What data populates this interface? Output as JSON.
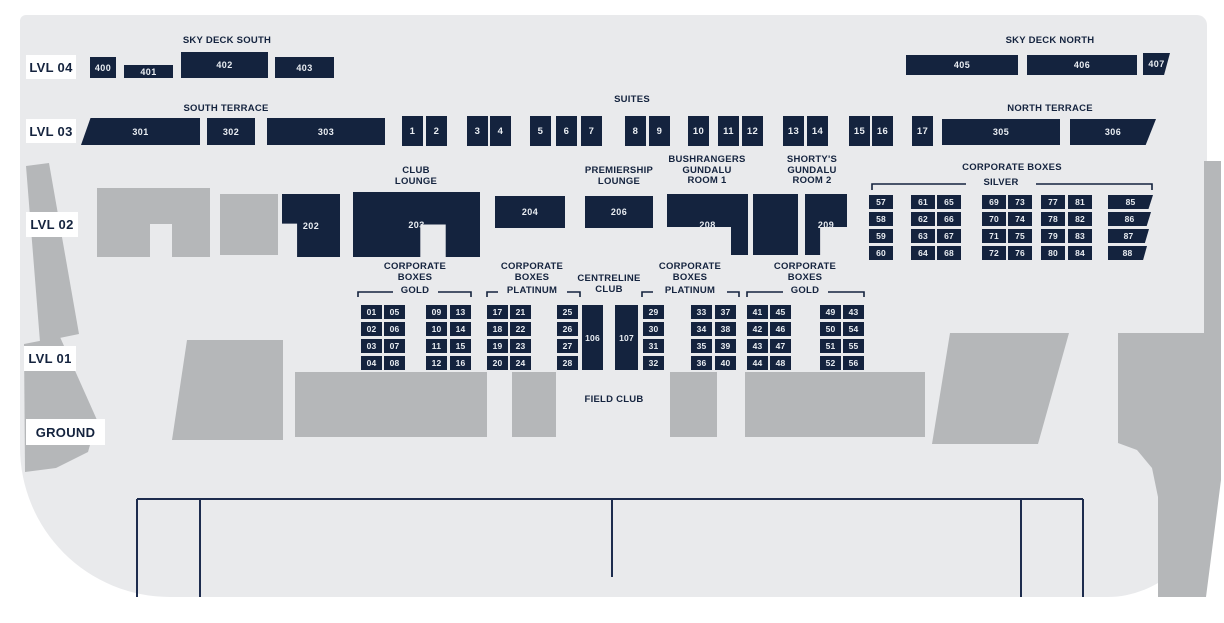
{
  "palette": {
    "navy": "#14233e",
    "bg": "#e9eaec",
    "gray": "#b5b7b9",
    "white": "#ffffff",
    "line": "#1d2c4e"
  },
  "map_bg": {
    "x": 20,
    "y": 15,
    "w": 1187,
    "h": 582
  },
  "level_labels": [
    {
      "id": "lvl-04",
      "text": "LVL 04",
      "x": 26,
      "y": 55,
      "w": 50,
      "h": 24
    },
    {
      "id": "lvl-03",
      "text": "LVL 03",
      "x": 26,
      "y": 119,
      "w": 50,
      "h": 24
    },
    {
      "id": "lvl-02",
      "text": "LVL 02",
      "x": 26,
      "y": 212,
      "w": 52,
      "h": 25
    },
    {
      "id": "lvl-01",
      "text": "LVL 01",
      "x": 24,
      "y": 346,
      "w": 52,
      "h": 25
    },
    {
      "id": "ground",
      "text": "GROUND",
      "x": 26,
      "y": 419,
      "w": 79,
      "h": 26
    }
  ],
  "headers": [
    {
      "name": "sky-deck-south-header",
      "lines": [
        "SKY DECK SOUTH"
      ],
      "cx": 227,
      "y": 36
    },
    {
      "name": "sky-deck-north-header",
      "lines": [
        "SKY DECK NORTH"
      ],
      "cx": 1050,
      "y": 36
    },
    {
      "name": "south-terrace-header",
      "lines": [
        "SOUTH TERRACE"
      ],
      "cx": 226,
      "y": 104
    },
    {
      "name": "suites-header",
      "lines": [
        "SUITES"
      ],
      "cx": 632,
      "y": 95
    },
    {
      "name": "north-terrace-header",
      "lines": [
        "NORTH TERRACE"
      ],
      "cx": 1050,
      "y": 104
    },
    {
      "name": "club-lounge-header",
      "lines": [
        "CLUB",
        "LOUNGE"
      ],
      "cx": 416,
      "y": 166
    },
    {
      "name": "premiership-lounge-header",
      "lines": [
        "PREMIERSHIP",
        "LOUNGE"
      ],
      "cx": 619,
      "y": 166
    },
    {
      "name": "bushrangers-gundalu-room-1-header",
      "lines": [
        "BUSHRANGERS",
        "GUNDALU",
        "ROOM 1"
      ],
      "cx": 707,
      "y": 155
    },
    {
      "name": "shortys-gundalu-room-2-header",
      "lines": [
        "SHORTY'S",
        "GUNDALU",
        "ROOM 2"
      ],
      "cx": 812,
      "y": 155
    },
    {
      "name": "corporate-boxes-silver-header",
      "lines": [
        "CORPORATE BOXES"
      ],
      "cx": 1012,
      "y": 163
    },
    {
      "name": "silver-label",
      "lines": [
        "SILVER"
      ],
      "cx": 1001,
      "y": 178
    },
    {
      "name": "corporate-boxes-gold-left-header",
      "lines": [
        "CORPORATE",
        "BOXES"
      ],
      "cx": 415,
      "y": 262
    },
    {
      "name": "gold-left-label",
      "lines": [
        "GOLD"
      ],
      "cx": 415,
      "y": 286
    },
    {
      "name": "corporate-boxes-platinum-left-header",
      "lines": [
        "CORPORATE",
        "BOXES"
      ],
      "cx": 532,
      "y": 262
    },
    {
      "name": "platinum-left-label",
      "lines": [
        "PLATINUM"
      ],
      "cx": 532,
      "y": 286
    },
    {
      "name": "centreline-club-header",
      "lines": [
        "CENTRELINE",
        "CLUB"
      ],
      "cx": 609,
      "y": 274
    },
    {
      "name": "corporate-boxes-platinum-right-header",
      "lines": [
        "CORPORATE",
        "BOXES"
      ],
      "cx": 690,
      "y": 262
    },
    {
      "name": "platinum-right-label",
      "lines": [
        "PLATINUM"
      ],
      "cx": 690,
      "y": 286
    },
    {
      "name": "corporate-boxes-gold-right-header",
      "lines": [
        "CORPORATE",
        "BOXES"
      ],
      "cx": 805,
      "y": 262
    },
    {
      "name": "gold-right-label",
      "lines": [
        "GOLD"
      ],
      "cx": 805,
      "y": 286
    },
    {
      "name": "field-club-label",
      "lines": [
        "FIELD CLUB"
      ],
      "cx": 614,
      "y": 395
    }
  ],
  "brackets": [
    {
      "name": "silver-bracket",
      "x1": 872,
      "x2": 1152,
      "y": 184,
      "g1": 966,
      "g2": 1036,
      "tick": 6
    },
    {
      "name": "gold-left-bracket",
      "x1": 358,
      "x2": 471,
      "y": 292,
      "g1": 393,
      "g2": 438,
      "tick": 5
    },
    {
      "name": "platinum-left-bracket",
      "x1": 487,
      "x2": 580,
      "y": 292,
      "g1": 498,
      "g2": 567,
      "tick": 5
    },
    {
      "name": "platinum-right-bracket",
      "x1": 642,
      "x2": 739,
      "y": 292,
      "g1": 653,
      "g2": 727,
      "tick": 5
    },
    {
      "name": "gold-right-bracket",
      "x1": 747,
      "x2": 864,
      "y": 292,
      "g1": 783,
      "g2": 828,
      "tick": 5
    }
  ],
  "sections": [
    {
      "label": "400",
      "kind": "section",
      "x": 90,
      "y": 57,
      "w": 26,
      "h": 21
    },
    {
      "label": "401",
      "kind": "section",
      "x": 124,
      "y": 65,
      "w": 49,
      "h": 13
    },
    {
      "label": "402",
      "kind": "section",
      "x": 181,
      "y": 52,
      "w": 87,
      "h": 26
    },
    {
      "label": "403",
      "kind": "section",
      "x": 275,
      "y": 57,
      "w": 59,
      "h": 21
    },
    {
      "label": "405",
      "kind": "section",
      "x": 906,
      "y": 55,
      "w": 112,
      "h": 20
    },
    {
      "label": "406",
      "kind": "section",
      "x": 1027,
      "y": 55,
      "w": 110,
      "h": 20
    },
    {
      "label": "407",
      "kind": "section",
      "x": 1143,
      "y": 53,
      "w": 27,
      "h": 22,
      "clip": "polygon(0 0,100% 0,78% 100%,0 100%)"
    },
    {
      "label": "301",
      "kind": "section",
      "x": 81,
      "y": 118,
      "w": 119,
      "h": 27,
      "clip": "polygon(8% 0,100% 0,100% 100%,0 100%)"
    },
    {
      "label": "302",
      "kind": "section",
      "x": 207,
      "y": 118,
      "w": 48,
      "h": 27
    },
    {
      "label": "303",
      "kind": "section",
      "x": 267,
      "y": 118,
      "w": 118,
      "h": 27
    },
    {
      "label": "305",
      "kind": "section",
      "x": 942,
      "y": 119,
      "w": 118,
      "h": 26
    },
    {
      "label": "306",
      "kind": "section",
      "x": 1070,
      "y": 119,
      "w": 86,
      "h": 26,
      "clip": "polygon(0 0,100% 0,88% 100%,0 100%)"
    },
    {
      "label": "202",
      "kind": "section",
      "x": 282,
      "y": 194,
      "w": 58,
      "h": 63,
      "clip": "polygon(0 0,100% 0,100% 100%,26% 100%,26% 47%,0 47%)"
    },
    {
      "label": "203",
      "kind": "section",
      "x": 353,
      "y": 192,
      "w": 127,
      "h": 65,
      "clip": "polygon(0 0,100% 0,100% 100%,73% 100%,73% 50%,53% 50%,53% 100%,0 100%)"
    },
    {
      "label": "204",
      "kind": "section",
      "x": 495,
      "y": 196,
      "w": 70,
      "h": 32
    },
    {
      "label": "206",
      "kind": "section",
      "x": 585,
      "y": 196,
      "w": 68,
      "h": 32
    },
    {
      "label": "208",
      "kind": "section",
      "x": 667,
      "y": 194,
      "w": 81,
      "h": 61,
      "clip": "polygon(0 0,100% 0,100% 100%,79% 100%,79% 54%,0 54%)"
    },
    {
      "label": "",
      "kind": "section",
      "x": 753,
      "y": 194,
      "w": 45,
      "h": 61
    },
    {
      "label": "209",
      "kind": "section",
      "x": 805,
      "y": 194,
      "w": 42,
      "h": 61,
      "clip": "polygon(0 0,100% 0,100% 54%,36% 54%,36% 100%,0 100%)"
    },
    {
      "label": "106",
      "kind": "section",
      "x": 582,
      "y": 305,
      "w": 21,
      "h": 65,
      "corp": true
    },
    {
      "label": "107",
      "kind": "section",
      "x": 615,
      "y": 305,
      "w": 23,
      "h": 65,
      "corp": true
    }
  ],
  "suites": {
    "y": 116,
    "w": 21,
    "h": 30,
    "items": [
      {
        "label": "1",
        "x": 402
      },
      {
        "label": "2",
        "x": 426
      },
      {
        "label": "3",
        "x": 467
      },
      {
        "label": "4",
        "x": 490
      },
      {
        "label": "5",
        "x": 530
      },
      {
        "label": "6",
        "x": 556
      },
      {
        "label": "7",
        "x": 581
      },
      {
        "label": "8",
        "x": 625
      },
      {
        "label": "9",
        "x": 649
      },
      {
        "label": "10",
        "x": 688
      },
      {
        "label": "11",
        "x": 718
      },
      {
        "label": "12",
        "x": 742
      },
      {
        "label": "13",
        "x": 783
      },
      {
        "label": "14",
        "x": 807
      },
      {
        "label": "15",
        "x": 849
      },
      {
        "label": "16",
        "x": 872
      },
      {
        "label": "17",
        "x": 912
      }
    ]
  },
  "grids": [
    {
      "name": "corporate-boxes-silver",
      "w": 24,
      "h": 14,
      "row_ys": [
        195,
        212,
        229,
        246
      ],
      "cols": [
        {
          "x": 869,
          "labels": [
            "57",
            "58",
            "59",
            "60"
          ]
        },
        {
          "x": 911,
          "labels": [
            "61",
            "62",
            "63",
            "64"
          ]
        },
        {
          "x": 937,
          "labels": [
            "65",
            "66",
            "67",
            "68"
          ]
        },
        {
          "x": 982,
          "labels": [
            "69",
            "70",
            "71",
            "72"
          ]
        },
        {
          "x": 1008,
          "labels": [
            "73",
            "74",
            "75",
            "76"
          ]
        },
        {
          "x": 1041,
          "labels": [
            "77",
            "78",
            "79",
            "80"
          ]
        },
        {
          "x": 1068,
          "labels": [
            "81",
            "82",
            "83",
            "84"
          ]
        },
        {
          "x": 1108,
          "labels": [
            "85",
            "86",
            "87",
            "88"
          ],
          "widths": [
            45,
            43,
            41,
            39
          ],
          "clip": "polygon(0 0,100% 0,90% 100%,0 100%)"
        }
      ]
    },
    {
      "name": "corporate-boxes-lvl01",
      "w": 21,
      "h": 14,
      "row_ys": [
        305,
        322,
        339,
        356
      ],
      "cols": [
        {
          "x": 361,
          "labels": [
            "01",
            "02",
            "03",
            "04"
          ]
        },
        {
          "x": 384,
          "labels": [
            "05",
            "06",
            "07",
            "08"
          ]
        },
        {
          "x": 426,
          "labels": [
            "09",
            "10",
            "11",
            "12"
          ]
        },
        {
          "x": 450,
          "labels": [
            "13",
            "14",
            "15",
            "16"
          ]
        },
        {
          "x": 487,
          "labels": [
            "17",
            "18",
            "19",
            "20"
          ]
        },
        {
          "x": 510,
          "labels": [
            "21",
            "22",
            "23",
            "24"
          ]
        },
        {
          "x": 557,
          "labels": [
            "25",
            "26",
            "27",
            "28"
          ]
        },
        {
          "x": 643,
          "labels": [
            "29",
            "30",
            "31",
            "32"
          ]
        },
        {
          "x": 691,
          "labels": [
            "33",
            "34",
            "35",
            "36"
          ]
        },
        {
          "x": 715,
          "labels": [
            "37",
            "38",
            "39",
            "40"
          ]
        },
        {
          "x": 747,
          "labels": [
            "41",
            "42",
            "43",
            "44"
          ]
        },
        {
          "x": 770,
          "labels": [
            "45",
            "46",
            "47",
            "48"
          ]
        },
        {
          "x": 820,
          "labels": [
            "49",
            "50",
            "51",
            "52"
          ]
        },
        {
          "x": 843,
          "labels": [
            "43",
            "54",
            "55",
            "56"
          ]
        }
      ]
    }
  ],
  "gray_shapes": [
    {
      "points": "26,166 49,163 79,334 40,342"
    },
    {
      "points": "24,344 60,337 97,420 88,452 56,468 25,472"
    },
    {
      "points": "97,188 210,188 210,257 172,257 172,224 150,224 150,257 97,257"
    },
    {
      "points": "220,194 278,194 278,255 220,255"
    },
    {
      "points": "187,340 283,340 283,440 172,440"
    },
    {
      "points": "295,372 487,372 487,437 295,437"
    },
    {
      "points": "512,372 556,372 556,437 512,437"
    },
    {
      "points": "670,372 717,372 717,437 670,437"
    },
    {
      "points": "745,372 925,372 925,437 745,437"
    },
    {
      "points": "950,333 1069,333 1038,444 932,444"
    },
    {
      "points": "1204,161 1221,161 1221,338 1204,338"
    },
    {
      "points": "1118,333 1221,333 1221,480 1206,597 1158,597 1158,497 1152,468 1137,450 1118,443"
    }
  ],
  "field": {
    "top_line": {
      "x1": 137,
      "x2": 1083,
      "y": 499
    },
    "verticals": [
      {
        "x": 137,
        "y1": 499,
        "y2": 597
      },
      {
        "x": 200,
        "y1": 499,
        "y2": 597
      },
      {
        "x": 612,
        "y1": 499,
        "y2": 577
      },
      {
        "x": 1021,
        "y1": 499,
        "y2": 597
      },
      {
        "x": 1083,
        "y1": 499,
        "y2": 597
      }
    ]
  }
}
